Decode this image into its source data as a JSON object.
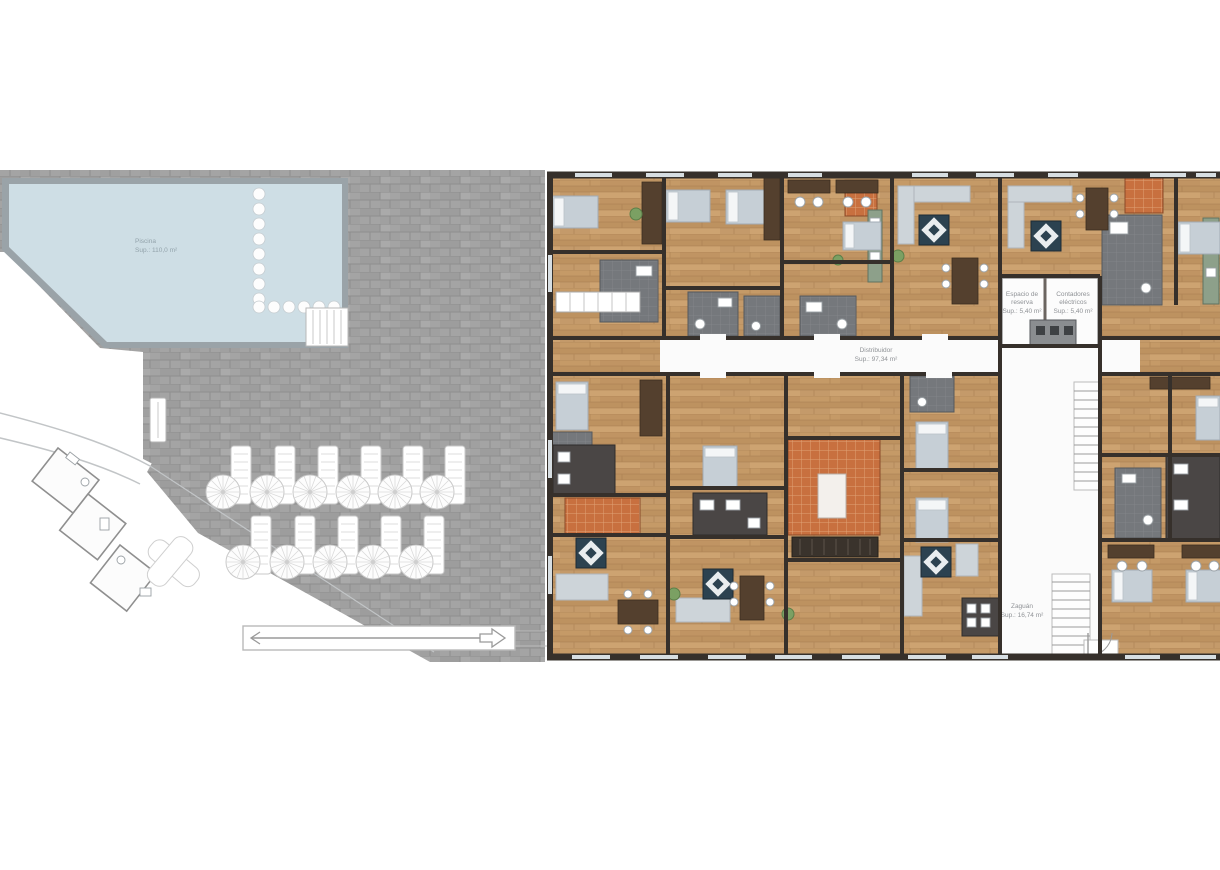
{
  "document": {
    "kind": "architectural floor plan",
    "language": "Spanish"
  },
  "labels": {
    "piscina": {
      "line1": "Piscina",
      "line2": "Sup.: 110,0 m²"
    },
    "distribuidor": {
      "line1": "Distribuidor",
      "line2": "Sup.: 97,34 m²"
    },
    "espacio": {
      "line1": "Espacio de",
      "line2": "reserva",
      "line3": "Sup.: 5,40 m²"
    },
    "contadores": {
      "line1": "Contadores",
      "line2": "eléctricos",
      "line3": "Sup.: 5,40 m²"
    },
    "zaguan": {
      "line1": "Zaguán",
      "line2": "Sup.: 16,74 m²"
    }
  },
  "outdoor": {
    "parasol_tables_top_row": 6,
    "parasol_tables_bottom_row": 5,
    "pool_stepping_stones_column": 8,
    "pool_stepping_stones_row": 6
  },
  "colors": {
    "pool_water": "#cedee5",
    "pool_edge": "#9aa3a8",
    "terrace_paving": "#a4a4a4",
    "wood_floor": "#c59a67",
    "walls": "#36302b",
    "bathroom_tile": "#75787c",
    "terracotta_tile": "#c8703f",
    "furniture_gray": "#c6cfd6",
    "page_background": "#ffffff"
  }
}
